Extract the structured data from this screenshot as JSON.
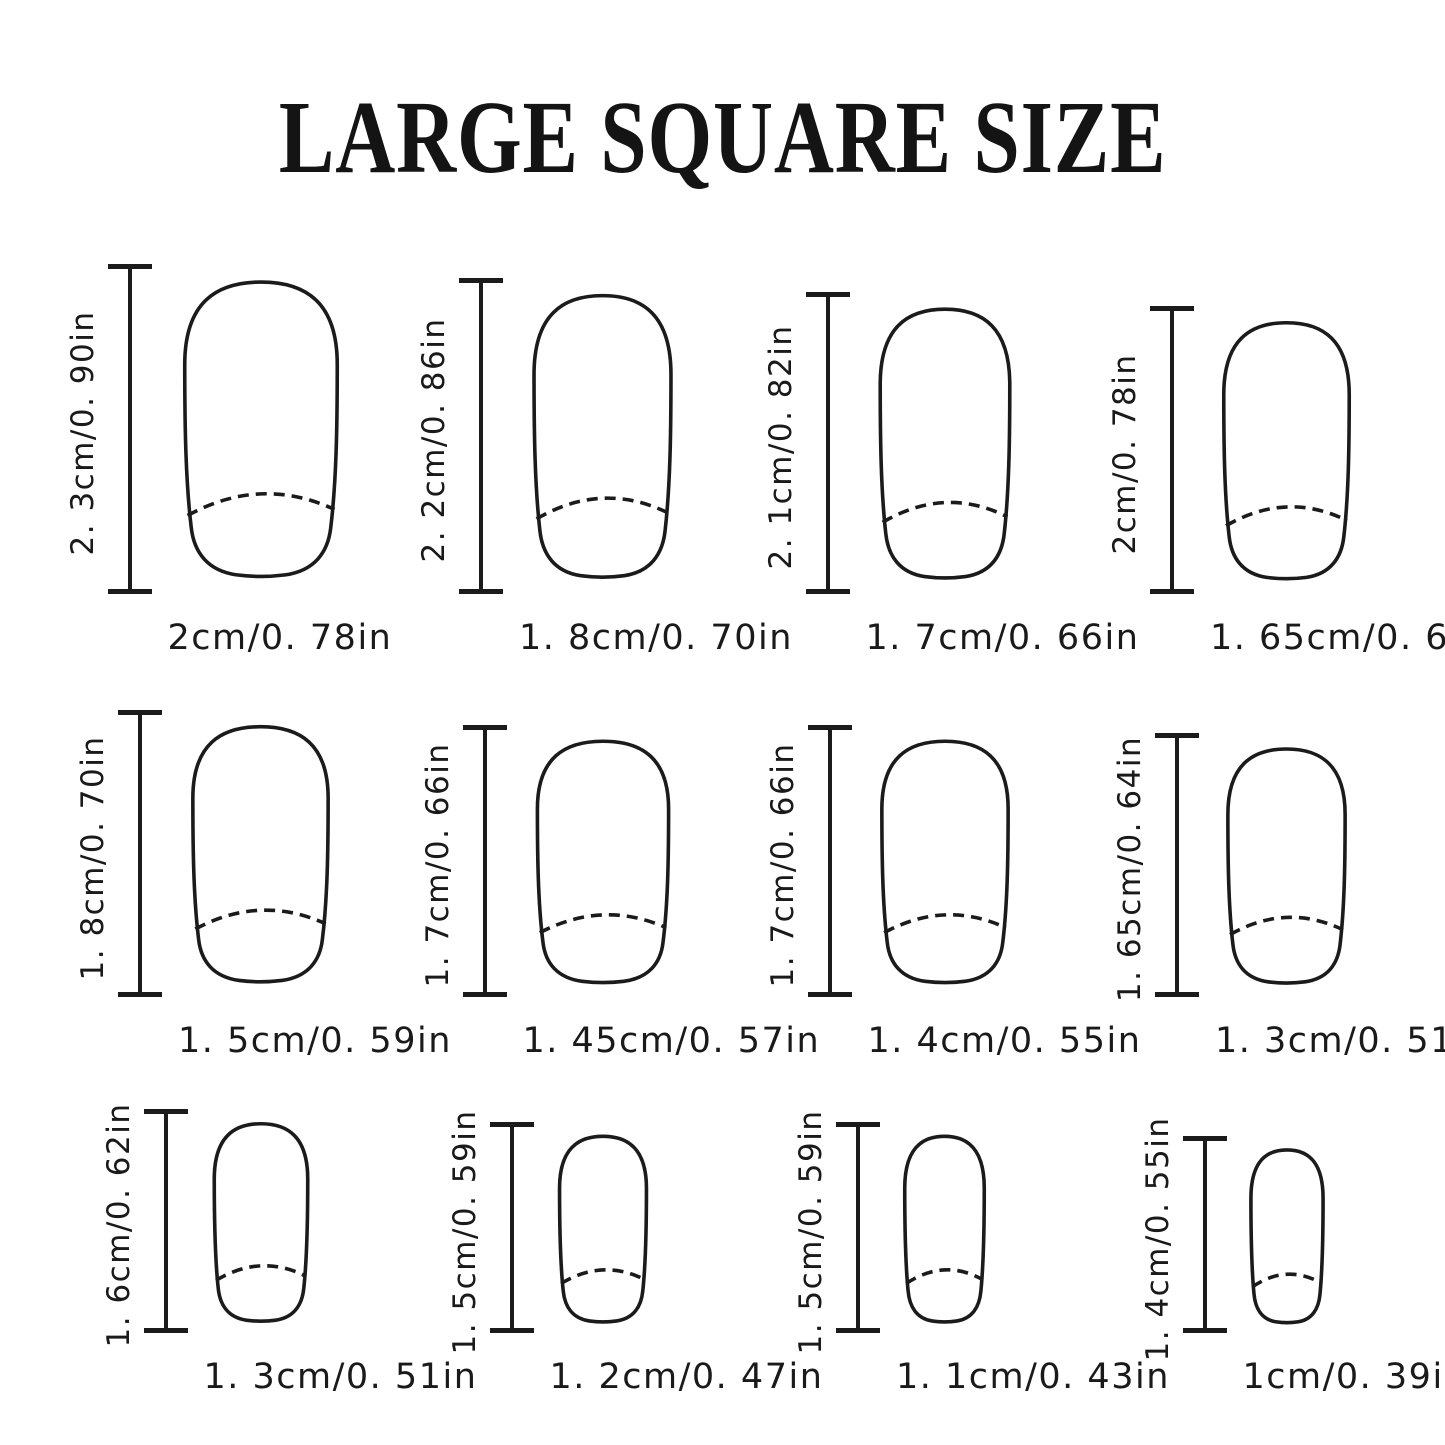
{
  "title": "LARGE SQUARE SIZE",
  "nails": [
    {
      "height_label": "2. 3cm/0. 90in",
      "width_label": "2cm/0. 78in",
      "height_cm": 2.3,
      "width_cm": 2.0
    },
    {
      "height_label": "2. 2cm/0. 86in",
      "width_label": "1. 8cm/0. 70in",
      "height_cm": 2.2,
      "width_cm": 1.8
    },
    {
      "height_label": "2. 1cm/0. 82in",
      "width_label": "1. 7cm/0. 66in",
      "height_cm": 2.1,
      "width_cm": 1.7
    },
    {
      "height_label": "2cm/0. 78in",
      "width_label": "1. 65cm/0. 64in",
      "height_cm": 2.0,
      "width_cm": 1.65
    },
    {
      "height_label": "1. 8cm/0. 70in",
      "width_label": "1. 5cm/0. 59in",
      "height_cm": 1.8,
      "width_cm": 1.5
    },
    {
      "height_label": "1. 7cm/0. 66in",
      "width_label": "1. 45cm/0. 57in",
      "height_cm": 1.7,
      "width_cm": 1.45
    },
    {
      "height_label": "1. 7cm/0. 66in",
      "width_label": "1. 4cm/0. 55in",
      "height_cm": 1.7,
      "width_cm": 1.4
    },
    {
      "height_label": "1. 65cm/0. 64in",
      "width_label": "1. 3cm/0. 51in",
      "height_cm": 1.65,
      "width_cm": 1.3
    },
    {
      "height_label": "1. 6cm/0. 62in",
      "width_label": "1. 3cm/0. 51in",
      "height_cm": 1.6,
      "width_cm": 1.3
    },
    {
      "height_label": "1. 5cm/0. 59in",
      "width_label": "1. 2cm/0. 47in",
      "height_cm": 1.5,
      "width_cm": 1.2
    },
    {
      "height_label": "1. 5cm/0. 59in",
      "width_label": "1. 1cm/0. 43in",
      "height_cm": 1.5,
      "width_cm": 1.1
    },
    {
      "height_label": "1. 4cm/0. 55in",
      "width_label": "1cm/0. 39in",
      "height_cm": 1.4,
      "width_cm": 1.0
    }
  ],
  "colors": {
    "ink": "#1b1b1b",
    "background": "#ffffff"
  }
}
